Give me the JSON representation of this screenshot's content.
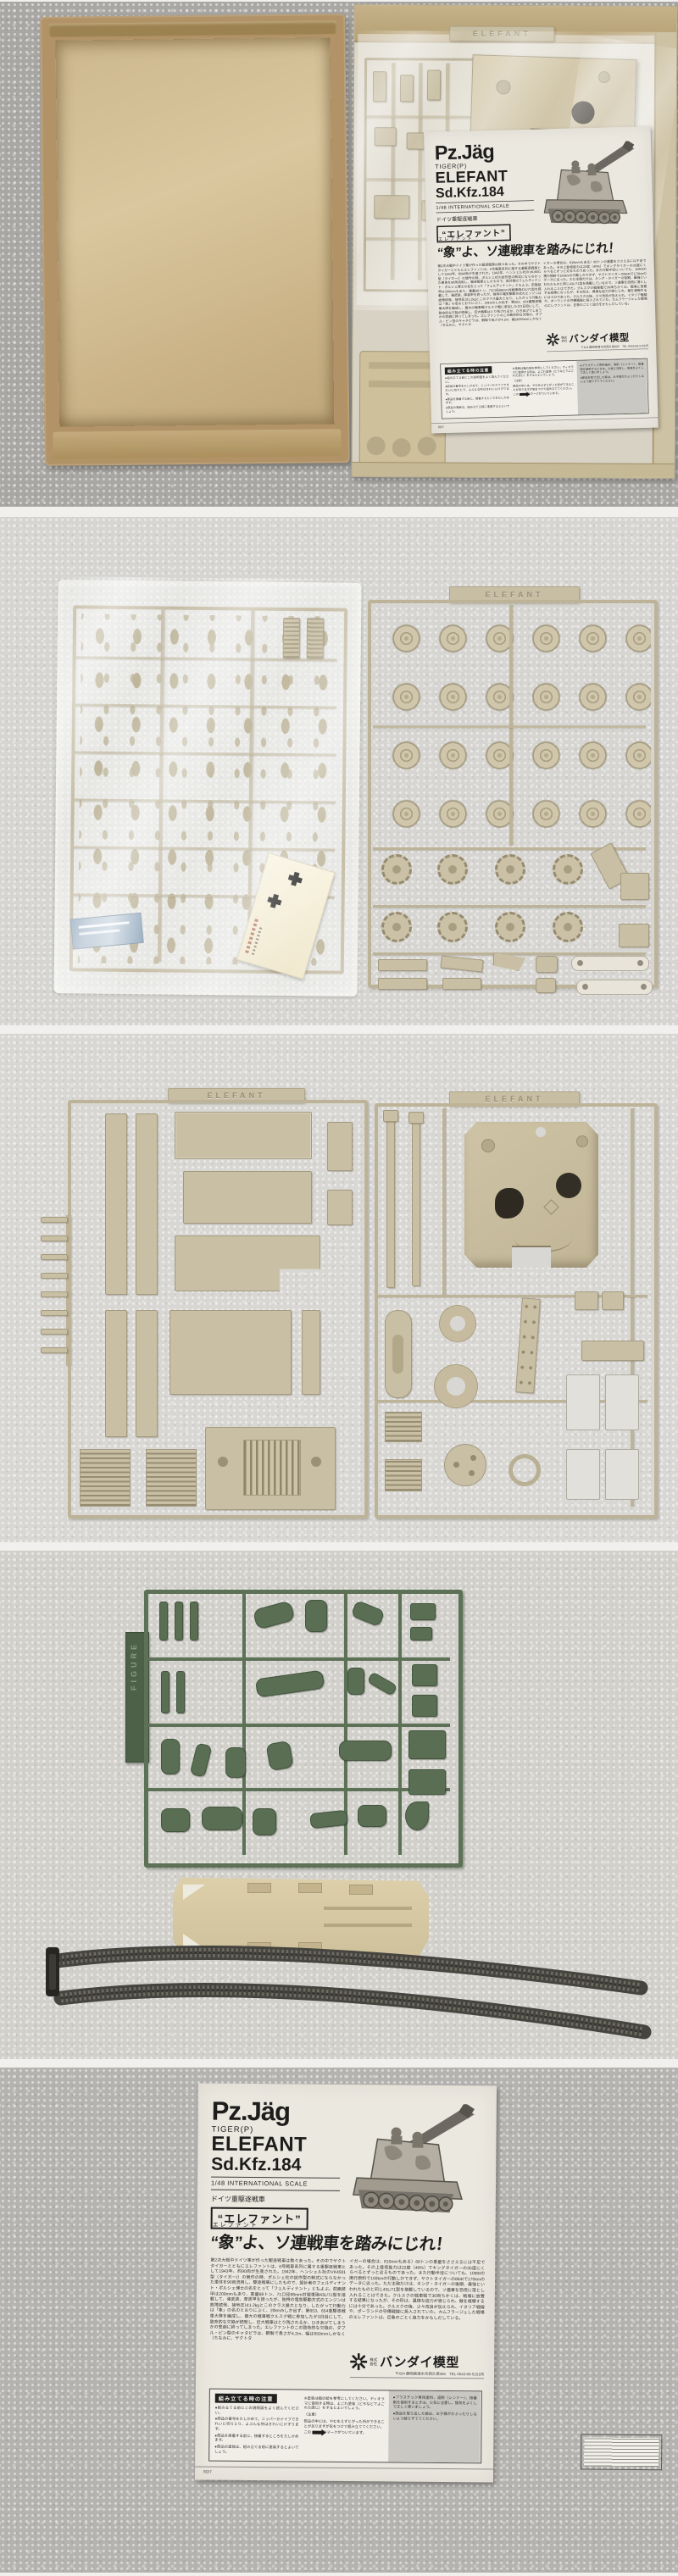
{
  "manual": {
    "title_main": "Pz.Jäg",
    "title_tiger": "TIGER(P)",
    "title_elefant": "ELEFANT",
    "title_sdkfz": "Sd.Kfz.184",
    "scale_line": "1/48 INTERNATIONAL SCALE",
    "class_line": "ドイツ重駆逐戦車",
    "name_badge": "“エレファント”",
    "kicker": "エレファント",
    "headline": "“象”よ、ソ連戦車を踏みにじれ！",
    "body_col1": "第2次大戦中ドイツ軍が作った駆逐戦車は数々あった。その中でヤクトタイガーとともにエレファントは、6号戦車系列に属する重駆逐戦車として1943年、約90両が生産された。1942年、ヘンシェル社のVK4501型（タイガーI）の競作の時、ポルシェ社の試作型の制式にならなかった車体を90両流用し、駆逐戦車にしたもので、設計者のフェルディナント・ポルシェ博士の名をとって「フェルディナント」ともよぶ。前面装甲は200mmもあり、重量68トン、71口径88mm対戦車砲43L/71型を搭載して、強武装、厚装甲を誇ったが、独特の電気駆動方式のエンジンは故障続発、接地圧は1.2kgとこのクラス最大となり、したがって行動力は「象」の名のとおりにぶく、20km/hしか出ず、第653、654重駆逐戦車大隊を編成し、最大の戦車戦クルスク戦に参加したが3日目にして、致命的な欠陥が続発し、巨大戦車はとり残されるか、ひきあげてしまうかの悲劇に終ってしまった。エレファントのこの致命的な欠陥の、ダブル・ピン型のキャタピラは、鋼製で長さが4.2m、幅は650mmしかなく（ちなみに、ヤクトタ",
    "body_col2": "イガーの場合は、810mmもある）68トンの重量をささえるには不足であった。その上登坂能力は22度（40%）でキングタイガーの35度にくらべるとずっと劣るものであった。また行動半径についても、1080ℓの携行燃料で150kmの行動しかできず、ヤクトタイガーの864ℓで170kmのデータに劣った。ただ主砲だけは、キング・タイガーの後期、最強といわれたものと同じ43L/71型を搭載しているので、ソ連軍を恐慌に落とし入れることはできた。クルスクの戦車戦で30両ちかくは、戦場に放置する結果になったが、その形は、異様な迫力が感じられ、敵を威嚇するには十分であった。クルスクの後、少々改良が加えられ、イタリア戦線や、ポーランドの守備戦線に投入されていた。カムフラージュした戦場のエレファントは、巨象のごとく迫力をかもしだしている。",
    "maker_prefix1": "株式",
    "maker_prefix2": "会社",
    "maker_name": "バンダイ模型",
    "maker_address": "〒424 静岡県清水市西久保305　TEL 0543-66-5151㈹",
    "notes_title": "組み立てる時の注意",
    "notes_col1": [
      "●組み立てる前にこの説明図をよく読んでください。",
      "●部品の番号をたしかめて、ニッパーかナイフできれいに切りとり、よぶんな所はきれいにけずります。",
      "●部品を接着する前に、接着するところをたしかめます。",
      "●部品の塗装は、組み立てる前に塗装するとよいでしょう。"
    ],
    "notes_col2": [
      "※塗装は箱の絵を参考にしてください。ディオラマに使用する時は、よごれ塗装（どろなどでよごれた感じ）をするとよいでしょう。",
      "〈注意〉",
      "部品の中には、やむをえずとがった所ができることがありますが気をつけて組み立ててください。"
    ],
    "notes_arrow_pre": "この",
    "notes_arrow_post": "のマークがついています。",
    "notes_col3": [
      "●プラスチック専用塗料、溶剤（シンナー）、接着剤を使用するときは、火気に注意し、換気をよくして正しく使いましょう。",
      "●部品を取り出した袋は、お子様がかぶったりしないよう破りすててください。"
    ],
    "footer_code": "80/7"
  },
  "sprues": {
    "elefant_tab": "ELEFANT",
    "figure_tab": "FIGURE"
  },
  "colors": {
    "cardboard": "#b29367",
    "sprue_tan": "#c9bfa4",
    "sprue_green": "#596e53",
    "track_gray": "#47463f",
    "paper": "#ebe8e0",
    "carpet_light": "#d6d5d1",
    "carpet_gray": "#a9a7a3"
  }
}
